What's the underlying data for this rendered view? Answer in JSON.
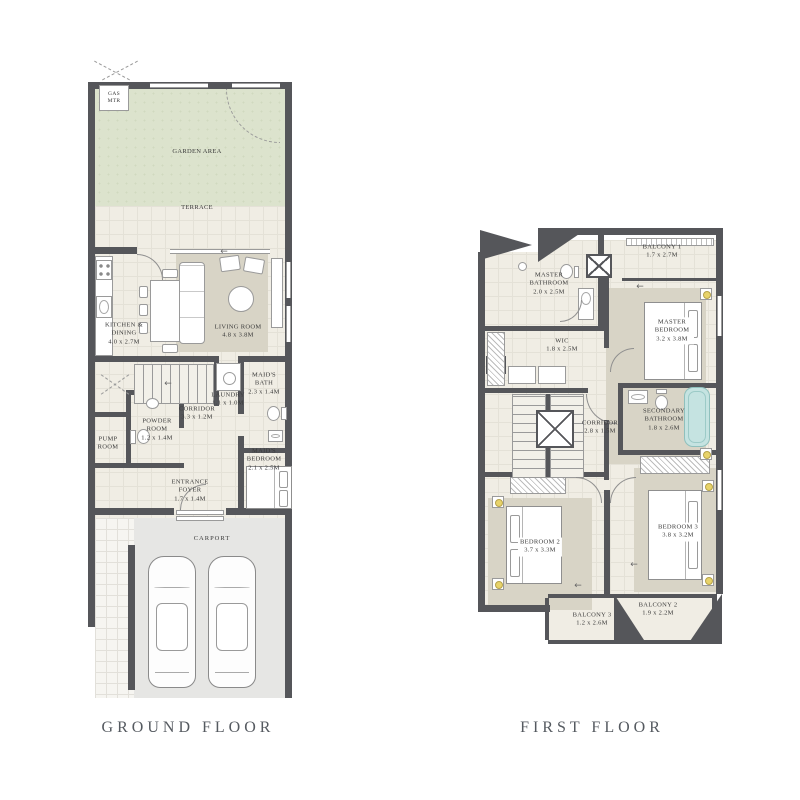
{
  "titles": {
    "ground": "GROUND FLOOR",
    "first": "FIRST FLOOR"
  },
  "colors": {
    "wall": "#55565a",
    "floor": "#f0ede4",
    "garden": "#dce3cd",
    "rug": "#d8d4c6",
    "carport": "#e6e6e4",
    "walkway": "#f6f5f1",
    "tub": "#c5e3e1",
    "lamp": "#e8d36a",
    "line": "#9a9a9a",
    "text": "#3a3a3a",
    "title": "#555a60"
  },
  "ground": {
    "labels": {
      "gas": {
        "name": "GAS MTR"
      },
      "garden": {
        "name": "GARDEN AREA"
      },
      "terrace": {
        "name": "TERRACE"
      },
      "living": {
        "name": "LIVING ROOM",
        "dims": "4.8 x 3.8M"
      },
      "kitchen": {
        "name": "KITCHEN & DINING",
        "dims": "4.0 x 2.7M"
      },
      "laundry": {
        "name": "LAUNDRY",
        "dims": "1.1 x 1.0M"
      },
      "maids_bath": {
        "name": "MAID'S BATH",
        "dims": "2.3 x 1.4M"
      },
      "corridor": {
        "name": "CORRIDOR",
        "dims": "3.3 x 1.2M"
      },
      "powder": {
        "name": "POWDER ROOM",
        "dims": "1.2 x 1.4M"
      },
      "pump": {
        "name": "PUMP ROOM"
      },
      "maids_bedroom": {
        "name": "MAID'S BEDROOM",
        "dims": "2.1 x 2.5M"
      },
      "foyer": {
        "name": "ENTRANCE FOYER",
        "dims": "1.7 x 1.4M"
      },
      "carport": {
        "name": "CARPORT"
      }
    }
  },
  "first": {
    "labels": {
      "master_bath": {
        "name": "MASTER BATHROOM",
        "dims": "2.0 x 2.5M"
      },
      "balcony1": {
        "name": "BALCONY 1",
        "dims": "1.7 x 2.7M"
      },
      "master_bedroom": {
        "name": "MASTER BEDROOM",
        "dims": "3.2 x 3.8M"
      },
      "wic": {
        "name": "WIC",
        "dims": "1.8 x 2.5M"
      },
      "corridor": {
        "name": "CORRIDOR",
        "dims": "2.8 x 1.5M"
      },
      "secondary_bath": {
        "name": "SECONDARY BATHROOM",
        "dims": "1.8 x 2.6M"
      },
      "bedroom2": {
        "name": "BEDROOM 2",
        "dims": "3.7 x 3.3M"
      },
      "bedroom3": {
        "name": "BEDROOM 3",
        "dims": "3.8 x 3.2M"
      },
      "balcony3": {
        "name": "BALCONY 3",
        "dims": "1.2 x 2.6M"
      },
      "balcony2": {
        "name": "BALCONY 2",
        "dims": "1.9 x 2.2M"
      }
    }
  }
}
